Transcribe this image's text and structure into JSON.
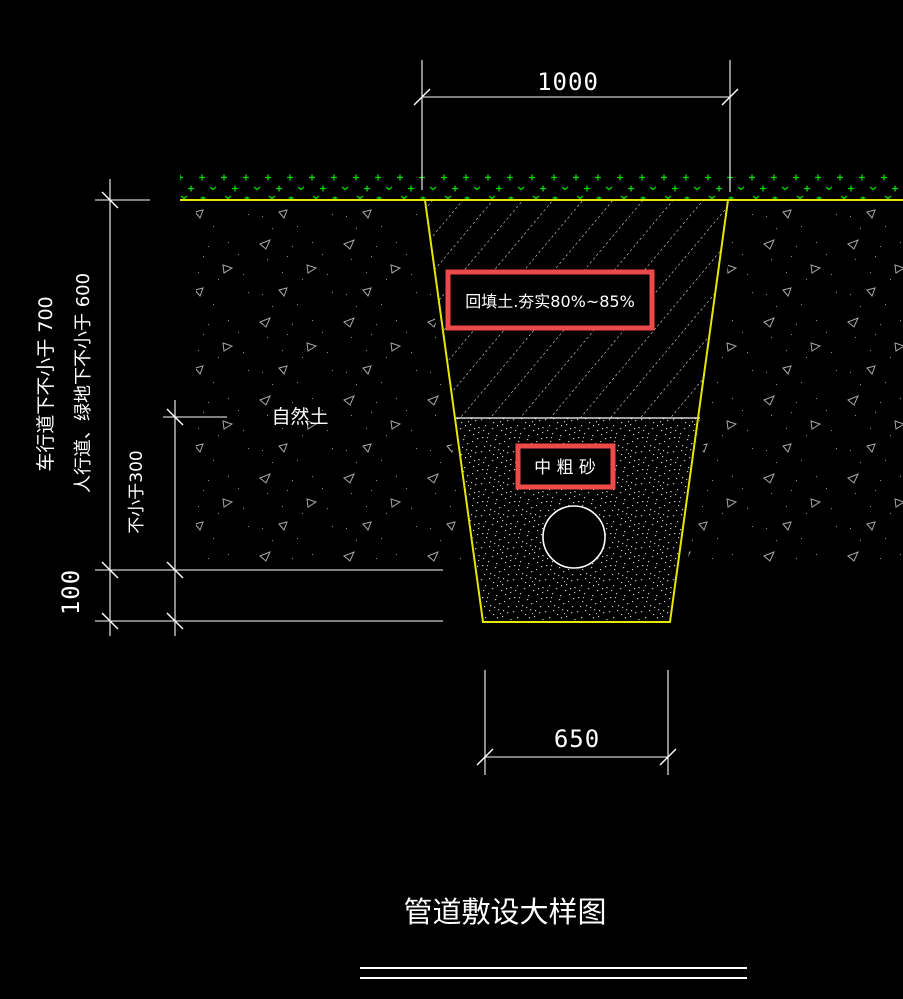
{
  "drawing": {
    "title": "管道敷设大样图",
    "dims": {
      "top_width": "1000",
      "bottom_width": "650",
      "cover_road": "车行道下不小于 700",
      "cover_walk": "人行道、绿地下不小于 600",
      "sand_min": "不小于300",
      "bedding": "100"
    },
    "labels": {
      "backfill": "回填土.夯实80%~85%",
      "sand": "中 粗 砂",
      "soil": "自然土"
    },
    "colors": {
      "background": "#000000",
      "lines_text": "#ffffff",
      "trench_ground": "#e6e600",
      "grass": "#00dc00",
      "soil_marks": "#a8a8a8",
      "sand_dots": "#c8c8c8",
      "highlight_box": "#ee4a4a"
    }
  }
}
